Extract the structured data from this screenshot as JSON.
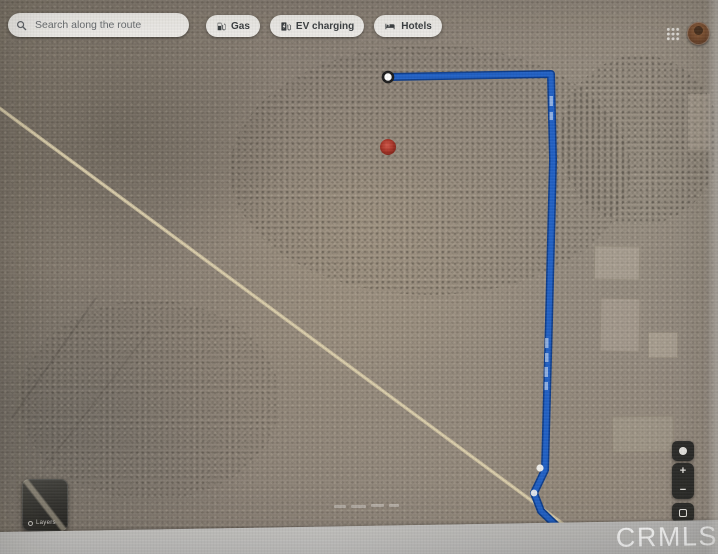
{
  "toolbar": {
    "search": {
      "placeholder": "Search along the route",
      "query": ""
    },
    "filters": [
      {
        "label": "Gas",
        "icon": "gas-pump-icon"
      },
      {
        "label": "EV charging",
        "icon": "ev-charger-icon"
      },
      {
        "label": "Hotels",
        "icon": "bed-icon"
      }
    ]
  },
  "account": {
    "apps_icon": "grid-icon",
    "avatar_icon": "user-avatar"
  },
  "map": {
    "view": "satellite",
    "route_color": "#2160c4",
    "route_casing_color": "#0d3d8c",
    "marker_color": "#b23527",
    "road_color": "#d8cba6",
    "start_marker": "white-circle",
    "destination_marker": "red-dot"
  },
  "controls": {
    "zoom_in": "+",
    "zoom_out": "−",
    "layers_label": "Layers"
  },
  "watermark": {
    "text": "CRMLS"
  }
}
